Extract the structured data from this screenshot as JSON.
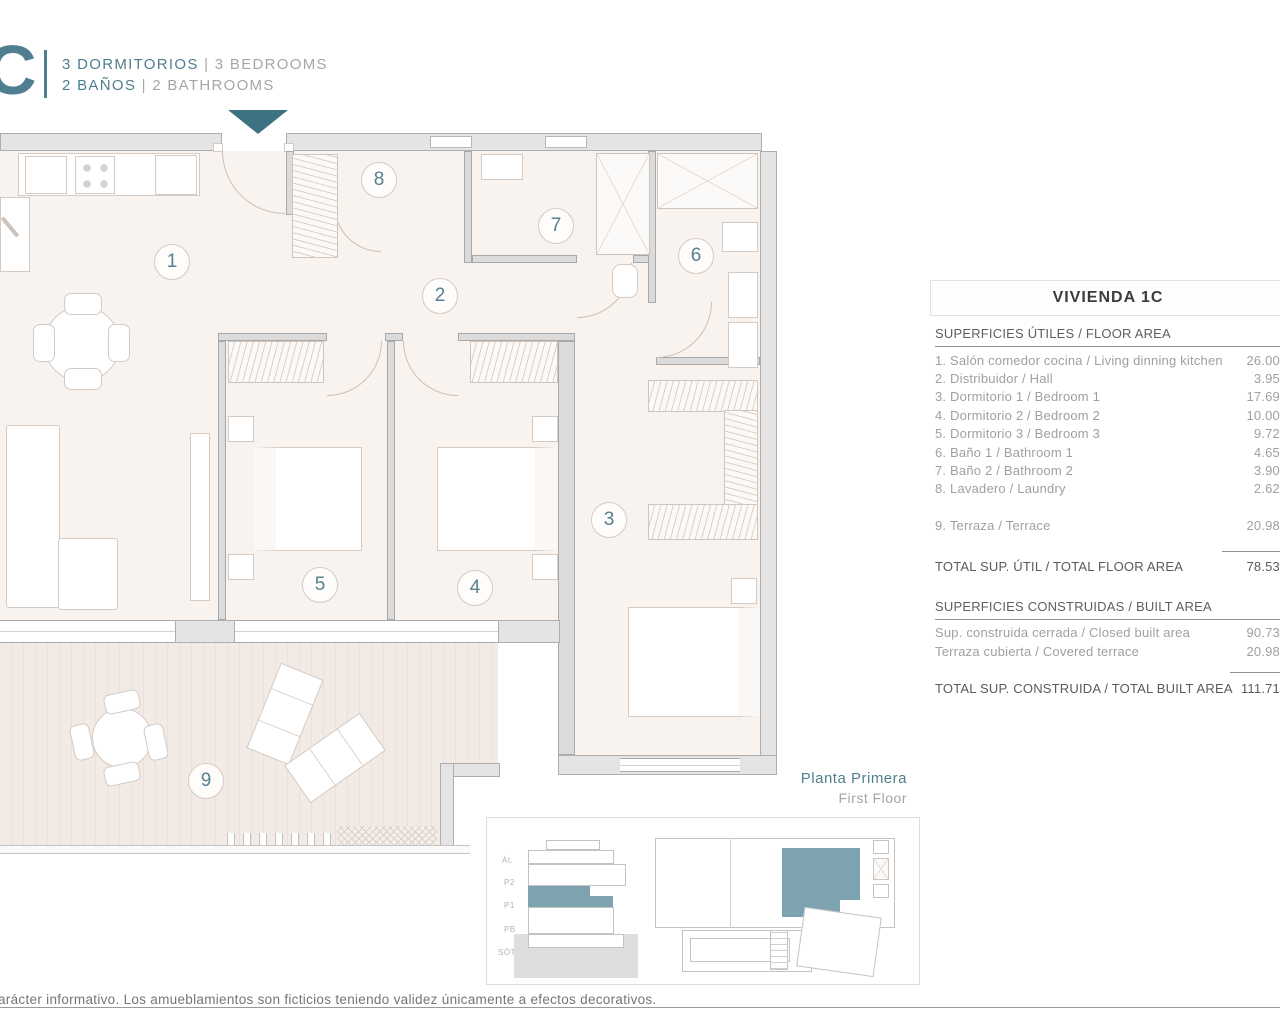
{
  "header": {
    "unit_letter": "C",
    "rooms_es": "3 DORMITORIOS",
    "rooms_en": "3 BEDROOMS",
    "baths_es": "2 BAÑOS",
    "baths_en": "2 BATHROOMS",
    "separator": "|"
  },
  "plan": {
    "rooms": [
      "1",
      "2",
      "3",
      "4",
      "5",
      "6",
      "7",
      "8",
      "9"
    ]
  },
  "panel": {
    "title": "VIVIENDA 1C",
    "floor_area": {
      "header": "SUPERFICIES ÚTILES / FLOOR AREA",
      "rows": [
        {
          "label": "1. Salón comedor cocina / Living dinning kitchen",
          "value": "26.00"
        },
        {
          "label": "2. Distribuidor / Hall",
          "value": "3.95"
        },
        {
          "label": "3. Dormitorio 1 / Bedroom 1",
          "value": "17.69"
        },
        {
          "label": "4. Dormitorio 2 / Bedroom 2",
          "value": "10.00"
        },
        {
          "label": "5. Dormitorio 3 / Bedroom 3",
          "value": "9.72"
        },
        {
          "label": "6. Baño 1 / Bathroom 1",
          "value": "4.65"
        },
        {
          "label": "7. Baño 2 / Bathroom 2",
          "value": "3.90"
        },
        {
          "label": "8. Lavadero / Laundry",
          "value": "2.62"
        }
      ],
      "terrace_row": {
        "label": "9. Terraza / Terrace",
        "value": "20.98"
      },
      "total": {
        "label": "TOTAL SUP. ÚTIL / TOTAL FLOOR AREA",
        "value": "78.53"
      }
    },
    "built_area": {
      "header": "SUPERFICIES CONSTRUIDAS / BUILT AREA",
      "rows": [
        {
          "label": "Sup. construida cerrada / Closed built area",
          "value": "90.73"
        },
        {
          "label": "Terraza cubierta / Covered terrace",
          "value": "20.98"
        }
      ],
      "total": {
        "label": "TOTAL SUP. CONSTRUIDA /  TOTAL BUILT AREA",
        "value": "111.71"
      }
    }
  },
  "floor_label": {
    "es": "Planta Primera",
    "en": "First Floor"
  },
  "mini_plan": {
    "levels": [
      "Át.",
      "P2",
      "P1",
      "PB",
      "SÓT."
    ]
  },
  "footer": {
    "disclaimer": "arácter informativo. Los amueblamientos son ficticios teniendo validez únicamente a efectos decorativos."
  },
  "colors": {
    "accent_teal": "#4e7e8f",
    "arrow_teal": "#3c7282",
    "mini_teal": "#7da2b0"
  }
}
